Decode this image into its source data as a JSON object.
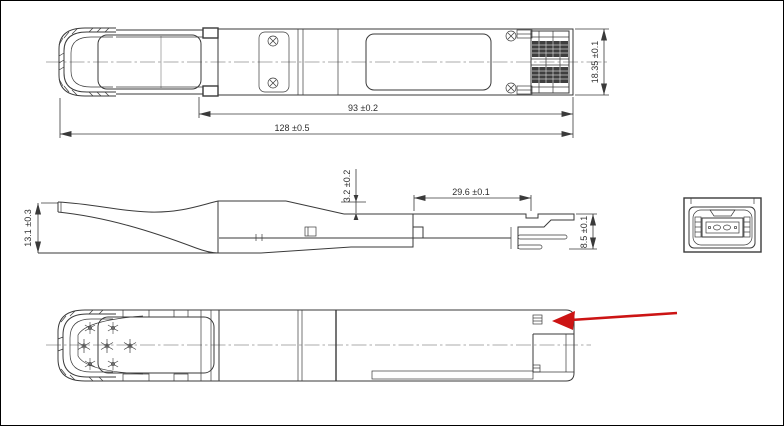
{
  "drawing": {
    "dims": {
      "top_body_length": "93 ±0.2",
      "top_overall_length": "128 ±0.5",
      "top_width": "18.35 ±0.1",
      "side_height": "13.1 ±0.3",
      "side_top_recess": "3.2 ±0.2",
      "side_rear_length": "29.6 ±0.1",
      "side_rear_height": "8.5 ±0.1"
    },
    "colors": {
      "line": "#3a3a3a",
      "centerline": "#909090",
      "callout_arrow": "#cc1414",
      "background": "#ffffff"
    }
  }
}
